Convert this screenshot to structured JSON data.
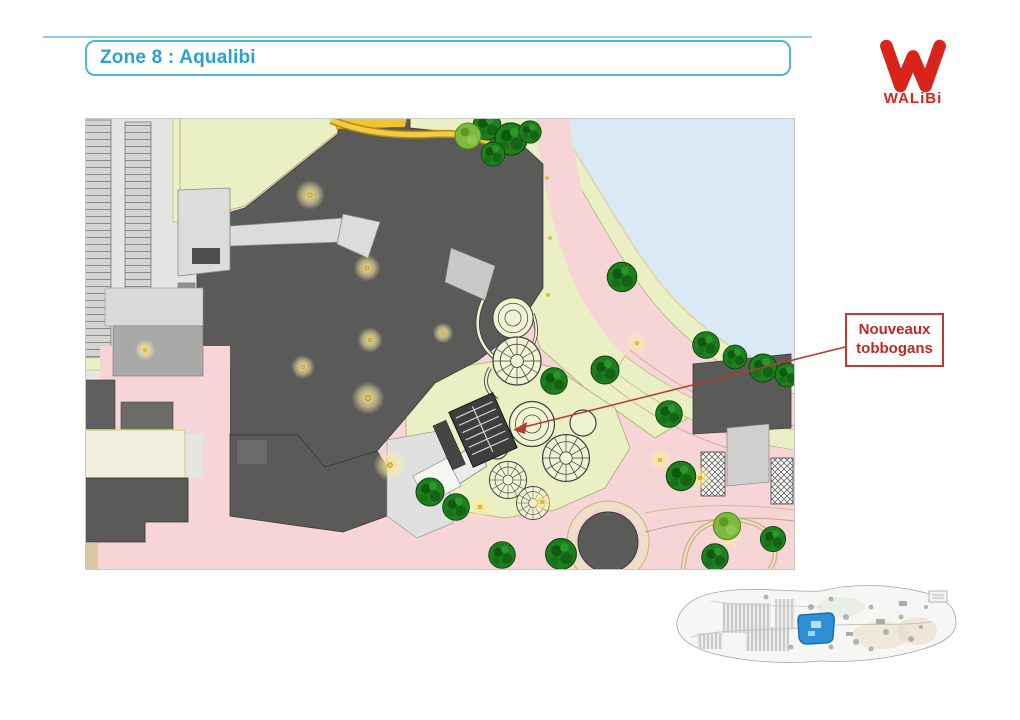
{
  "header": {
    "title": "Zone 8 : Aqualibi",
    "title_color": "#2AA2D0",
    "box_border_color": "#4FB6DC"
  },
  "logo": {
    "wordmark": "WALiBi",
    "color": "#D9241C"
  },
  "callout": {
    "line1": "Nouveaux",
    "line2": "tobbogans",
    "text_color": "#C02824",
    "border_color": "#C23A30",
    "leader_color": "#B8392E"
  },
  "site_plan": {
    "palette": {
      "building_dark": "#5A5A58",
      "path_pink": "#F7D5D7",
      "grass_green": "#EAF0C3",
      "lake_blue": "#D9EAF6",
      "tree_green": "#1F7E1F",
      "parking_gray": "#E5E5E3",
      "coaster_yellow": "#F2CC45",
      "lamp_yellow": "#E9C63B"
    }
  },
  "overview": {
    "highlight_color": "#2E8FD5"
  }
}
